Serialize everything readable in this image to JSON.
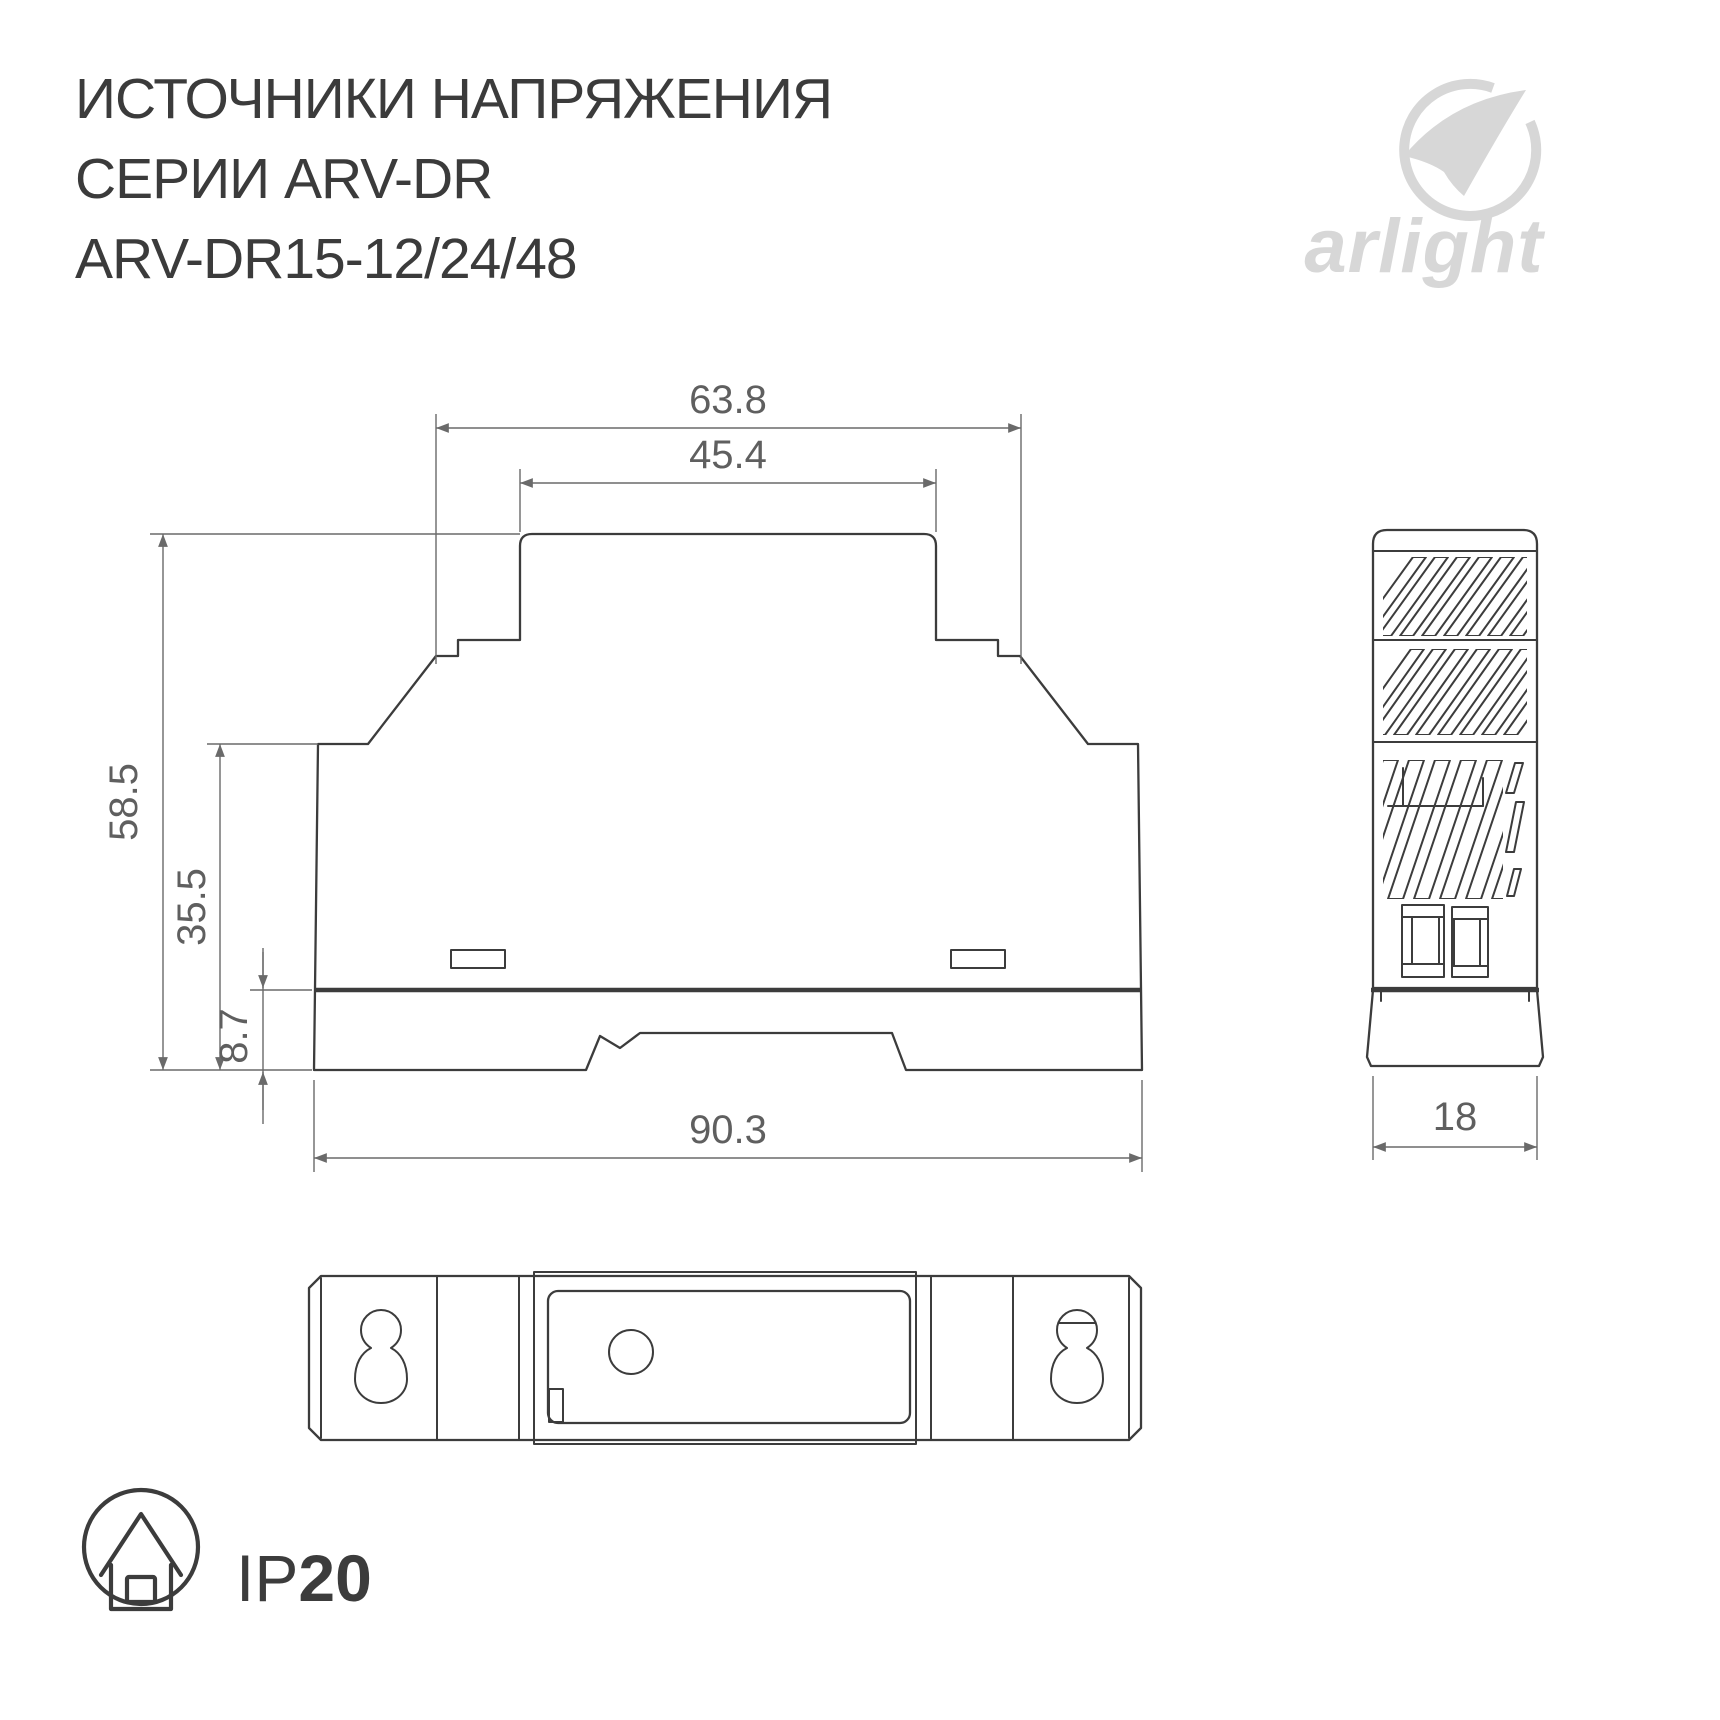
{
  "page": {
    "background": "#ffffff"
  },
  "header": {
    "title_line1": "ИСТОЧНИКИ НАПРЯЖЕНИЯ",
    "title_line2": "СЕРИИ ARV-DR",
    "title_line3": "ARV-DR15-12/24/48"
  },
  "logo": {
    "brand": "arlight",
    "color": "#d7d7d7"
  },
  "front_view": {
    "dim_step_width": "63.8",
    "dim_top_width": "45.4",
    "dim_total_height": "58.5",
    "dim_body_height": "35.5",
    "dim_base_height": "8.7",
    "dim_overall_width": "90.3"
  },
  "side_view": {
    "dim_depth": "18"
  },
  "ip_badge": {
    "prefix": "IP",
    "value": "20"
  },
  "colors": {
    "outline": "#3c3c3c",
    "dimension": "#6a6a6a",
    "title_text": "#3b3b3b"
  }
}
